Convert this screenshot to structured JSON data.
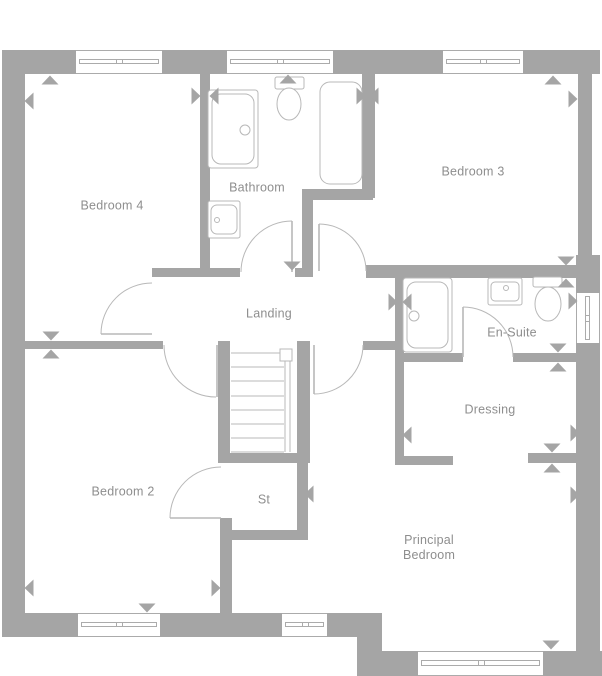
{
  "app": {
    "type": "floorplan",
    "floor": "first-floor"
  },
  "canvas": {
    "width": 602,
    "height": 676
  },
  "colors": {
    "wall": "#a5a5a5",
    "fixture_line": "#b8b8b8",
    "window_line": "#ababab",
    "label_text": "#8e8e8e",
    "background": "#ffffff"
  },
  "rooms": [
    {
      "id": "bedroom-4",
      "label": "Bedroom 4",
      "cx": 112,
      "cy": 206
    },
    {
      "id": "bathroom",
      "label": "Bathroom",
      "cx": 257,
      "cy": 188
    },
    {
      "id": "bedroom-3",
      "label": "Bedroom 3",
      "cx": 473,
      "cy": 172
    },
    {
      "id": "landing",
      "label": "Landing",
      "cx": 269,
      "cy": 314
    },
    {
      "id": "en-suite",
      "label": "En-Suite",
      "cx": 512,
      "cy": 333
    },
    {
      "id": "dressing",
      "label": "Dressing",
      "cx": 490,
      "cy": 410
    },
    {
      "id": "bedroom-2",
      "label": "Bedroom 2",
      "cx": 123,
      "cy": 492
    },
    {
      "id": "store",
      "label": "St",
      "cx": 264,
      "cy": 500
    },
    {
      "id": "principal-bedroom",
      "label": "Principal\nBedroom",
      "cx": 429,
      "cy": 548
    }
  ],
  "walls": [
    {
      "name": "outer-wall-top",
      "x": 2,
      "y": 50,
      "w": 598,
      "h": 24
    },
    {
      "name": "outer-wall-left",
      "x": 2,
      "y": 50,
      "w": 23,
      "h": 587
    },
    {
      "name": "outer-wall-bottom-left",
      "x": 2,
      "y": 613,
      "w": 378,
      "h": 24
    },
    {
      "name": "outer-wall-step",
      "x": 357,
      "y": 613,
      "w": 25,
      "h": 62
    },
    {
      "name": "outer-wall-bottom-right",
      "x": 357,
      "y": 651,
      "w": 245,
      "h": 25
    },
    {
      "name": "outer-wall-right-upper",
      "x": 578,
      "y": 50,
      "w": 14,
      "h": 215
    },
    {
      "name": "outer-wall-right-lower",
      "x": 576,
      "y": 255,
      "w": 24,
      "h": 421
    },
    {
      "name": "wall-bed4-bathroom",
      "x": 200,
      "y": 73,
      "w": 10,
      "h": 204
    },
    {
      "name": "wall-bathroom-landing",
      "x": 152,
      "y": 268,
      "w": 88,
      "h": 9
    },
    {
      "name": "wall-bathroom-landing-stub",
      "x": 295,
      "y": 268,
      "w": 18,
      "h": 9
    },
    {
      "name": "wall-bed4-bed2",
      "x": 25,
      "y": 341,
      "w": 138,
      "h": 8
    },
    {
      "name": "wall-bathroom-bed3",
      "x": 362,
      "y": 73,
      "w": 13,
      "h": 125
    },
    {
      "name": "wall-bathroom-nook-h",
      "x": 302,
      "y": 189,
      "w": 71,
      "h": 11
    },
    {
      "name": "wall-bathroom-nook-v",
      "x": 302,
      "y": 200,
      "w": 11,
      "h": 77
    },
    {
      "name": "wall-bed3-ensuite",
      "x": 366,
      "y": 265,
      "w": 212,
      "h": 13
    },
    {
      "name": "wall-ensuite-west",
      "x": 395,
      "y": 270,
      "w": 9,
      "h": 83
    },
    {
      "name": "wall-ensuite-dressing-west",
      "x": 395,
      "y": 353,
      "w": 68,
      "h": 9
    },
    {
      "name": "wall-ensuite-dressing-east",
      "x": 513,
      "y": 353,
      "w": 65,
      "h": 9
    },
    {
      "name": "wall-dressing-west",
      "x": 395,
      "y": 353,
      "w": 9,
      "h": 112
    },
    {
      "name": "wall-dressing-south-stub",
      "x": 395,
      "y": 456,
      "w": 58,
      "h": 9
    },
    {
      "name": "wall-dressing-principal",
      "x": 528,
      "y": 453,
      "w": 50,
      "h": 10
    },
    {
      "name": "wall-landing-principal",
      "x": 363,
      "y": 341,
      "w": 41,
      "h": 9
    },
    {
      "name": "wall-stairs-west",
      "x": 218,
      "y": 341,
      "w": 12,
      "h": 121
    },
    {
      "name": "wall-stairs-east",
      "x": 297,
      "y": 341,
      "w": 13,
      "h": 121
    },
    {
      "name": "wall-stairs-store",
      "x": 218,
      "y": 453,
      "w": 92,
      "h": 10
    },
    {
      "name": "wall-store-south",
      "x": 220,
      "y": 530,
      "w": 88,
      "h": 10
    },
    {
      "name": "wall-store-east",
      "x": 297,
      "y": 462,
      "w": 11,
      "h": 78
    },
    {
      "name": "wall-bed2-principal",
      "x": 220,
      "y": 518,
      "w": 12,
      "h": 95
    }
  ],
  "windows": [
    {
      "name": "window-bedroom4",
      "x": 76,
      "y": 50,
      "w": 86,
      "h": 24,
      "o": "h"
    },
    {
      "name": "window-bathroom",
      "x": 227,
      "y": 50,
      "w": 106,
      "h": 24,
      "o": "h"
    },
    {
      "name": "window-bedroom3",
      "x": 443,
      "y": 50,
      "w": 80,
      "h": 24,
      "o": "h"
    },
    {
      "name": "window-ensuite",
      "x": 576,
      "y": 293,
      "w": 24,
      "h": 50,
      "o": "v"
    },
    {
      "name": "window-bedroom2",
      "x": 78,
      "y": 613,
      "w": 82,
      "h": 24,
      "o": "h"
    },
    {
      "name": "window-hall-bottom",
      "x": 282,
      "y": 613,
      "w": 45,
      "h": 24,
      "o": "h"
    },
    {
      "name": "window-principal",
      "x": 418,
      "y": 651,
      "w": 125,
      "h": 25,
      "o": "h"
    }
  ],
  "doors": [
    {
      "name": "door-bedroom-4",
      "arc": {
        "from": [
          152,
          283
        ],
        "to": [
          101,
          334
        ],
        "r": 51,
        "sweep": 0
      },
      "leaf": [
        [
          101,
          334
        ],
        [
          152,
          334
        ]
      ]
    },
    {
      "name": "door-bedroom-2",
      "arc": {
        "from": [
          164,
          345
        ],
        "to": [
          216,
          397
        ],
        "r": 52,
        "sweep": 0
      },
      "leaf": [
        [
          217,
          345
        ],
        [
          217,
          397
        ]
      ]
    },
    {
      "name": "door-bathroom",
      "arc": {
        "from": [
          241,
          272
        ],
        "to": [
          292,
          221
        ],
        "r": 51,
        "sweep": 1
      },
      "leaf": [
        [
          292,
          221
        ],
        [
          292,
          272
        ]
      ]
    },
    {
      "name": "door-bedroom-3",
      "arc": {
        "from": [
          319,
          224
        ],
        "to": [
          366,
          271
        ],
        "r": 47,
        "sweep": 1
      },
      "leaf": [
        [
          319,
          224
        ],
        [
          319,
          271
        ]
      ]
    },
    {
      "name": "door-principal-bedroom",
      "arc": {
        "from": [
          363,
          345
        ],
        "to": [
          314,
          394
        ],
        "r": 49,
        "sweep": 1
      },
      "leaf": [
        [
          314,
          345
        ],
        [
          314,
          394
        ]
      ]
    },
    {
      "name": "door-en-suite",
      "arc": {
        "from": [
          463,
          307
        ],
        "to": [
          513,
          357
        ],
        "r": 50,
        "sweep": 1
      },
      "leaf": [
        [
          463,
          307
        ],
        [
          463,
          357
        ]
      ]
    },
    {
      "name": "door-store",
      "arc": {
        "from": [
          221,
          467
        ],
        "to": [
          170,
          518
        ],
        "r": 51,
        "sweep": 0
      },
      "leaf": [
        [
          170,
          518
        ],
        [
          221,
          518
        ]
      ]
    }
  ],
  "stairs": {
    "treads": {
      "x1": 231,
      "x2": 284,
      "ys": [
        353,
        367,
        381,
        396,
        410,
        424,
        438,
        452
      ]
    },
    "rails": [
      {
        "x": 285,
        "y1": 360,
        "y2": 452
      },
      {
        "x": 290,
        "y1": 360,
        "y2": 452
      }
    ],
    "newel": {
      "x": 280,
      "y": 349,
      "w": 12,
      "h": 12
    }
  },
  "fixtures": [
    {
      "name": "bathroom-bath",
      "shapes": [
        {
          "k": "rr",
          "x": 208,
          "y": 90,
          "w": 50,
          "h": 78,
          "r": 3
        },
        {
          "k": "rr",
          "x": 212,
          "y": 94,
          "w": 42,
          "h": 70,
          "r": 9
        },
        {
          "k": "c",
          "cx": 245,
          "cy": 130,
          "r": 5
        }
      ]
    },
    {
      "name": "bathroom-bath-2",
      "shapes": [
        {
          "k": "rr",
          "x": 320,
          "y": 82,
          "w": 42,
          "h": 102,
          "r": 10
        }
      ]
    },
    {
      "name": "bathroom-toilet",
      "shapes": [
        {
          "k": "rr",
          "x": 275,
          "y": 77,
          "w": 29,
          "h": 12,
          "r": 2
        },
        {
          "k": "e",
          "cx": 289,
          "cy": 104,
          "rx": 12,
          "ry": 16
        }
      ]
    },
    {
      "name": "bathroom-basin",
      "shapes": [
        {
          "k": "rr",
          "x": 208,
          "y": 201,
          "w": 32,
          "h": 37,
          "r": 2
        },
        {
          "k": "rr",
          "x": 211,
          "y": 205,
          "w": 26,
          "h": 29,
          "r": 6
        },
        {
          "k": "c",
          "cx": 217,
          "cy": 220,
          "r": 2.5
        }
      ]
    },
    {
      "name": "ensuite-shower",
      "shapes": [
        {
          "k": "rr",
          "x": 403,
          "y": 278,
          "w": 49,
          "h": 74,
          "r": 3
        },
        {
          "k": "rr",
          "x": 407,
          "y": 282,
          "w": 41,
          "h": 66,
          "r": 9
        },
        {
          "k": "c",
          "cx": 414,
          "cy": 316,
          "r": 5
        }
      ]
    },
    {
      "name": "ensuite-basin",
      "shapes": [
        {
          "k": "rr",
          "x": 488,
          "y": 278,
          "w": 34,
          "h": 27,
          "r": 2
        },
        {
          "k": "rr",
          "x": 491,
          "y": 282,
          "w": 28,
          "h": 19,
          "r": 4
        },
        {
          "k": "c",
          "cx": 506,
          "cy": 288,
          "r": 2.5
        }
      ]
    },
    {
      "name": "ensuite-toilet",
      "shapes": [
        {
          "k": "rr",
          "x": 533,
          "y": 277,
          "w": 29,
          "h": 10,
          "r": 2
        },
        {
          "k": "e",
          "cx": 548,
          "cy": 304,
          "rx": 13,
          "ry": 17
        }
      ]
    }
  ],
  "markers": [
    {
      "cx": 50,
      "cy": 80,
      "dir": "up"
    },
    {
      "cx": 29,
      "cy": 101,
      "dir": "left"
    },
    {
      "cx": 196,
      "cy": 96,
      "dir": "right"
    },
    {
      "cx": 214,
      "cy": 96,
      "dir": "left"
    },
    {
      "cx": 361,
      "cy": 96,
      "dir": "right"
    },
    {
      "cx": 374,
      "cy": 96,
      "dir": "left"
    },
    {
      "cx": 553,
      "cy": 80,
      "dir": "up"
    },
    {
      "cx": 573,
      "cy": 99,
      "dir": "right"
    },
    {
      "cx": 288,
      "cy": 79,
      "dir": "up"
    },
    {
      "cx": 292,
      "cy": 266,
      "dir": "down"
    },
    {
      "cx": 566,
      "cy": 261,
      "dir": "down"
    },
    {
      "cx": 566,
      "cy": 283,
      "dir": "up"
    },
    {
      "cx": 393,
      "cy": 302,
      "dir": "right"
    },
    {
      "cx": 407,
      "cy": 302,
      "dir": "left"
    },
    {
      "cx": 573,
      "cy": 301,
      "dir": "right"
    },
    {
      "cx": 558,
      "cy": 348,
      "dir": "down"
    },
    {
      "cx": 558,
      "cy": 367,
      "dir": "up"
    },
    {
      "cx": 407,
      "cy": 435,
      "dir": "left"
    },
    {
      "cx": 575,
      "cy": 433,
      "dir": "right"
    },
    {
      "cx": 552,
      "cy": 448,
      "dir": "down"
    },
    {
      "cx": 552,
      "cy": 468,
      "dir": "up"
    },
    {
      "cx": 309,
      "cy": 494,
      "dir": "left"
    },
    {
      "cx": 575,
      "cy": 495,
      "dir": "right"
    },
    {
      "cx": 51,
      "cy": 336,
      "dir": "down"
    },
    {
      "cx": 51,
      "cy": 354,
      "dir": "up"
    },
    {
      "cx": 29,
      "cy": 588,
      "dir": "left"
    },
    {
      "cx": 216,
      "cy": 588,
      "dir": "right"
    },
    {
      "cx": 147,
      "cy": 608,
      "dir": "down"
    },
    {
      "cx": 551,
      "cy": 645,
      "dir": "down"
    }
  ]
}
